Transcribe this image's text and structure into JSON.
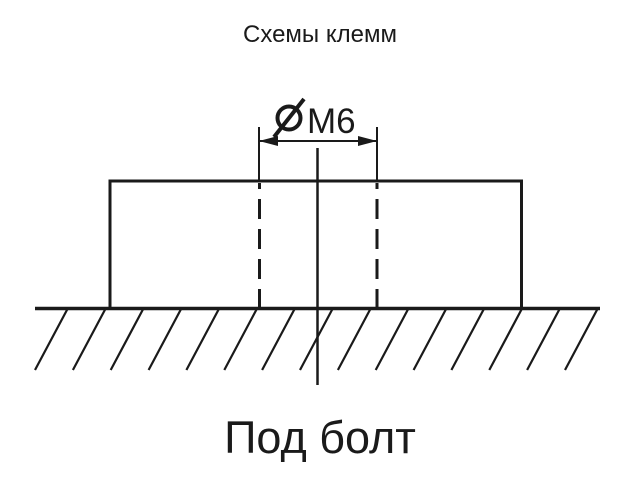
{
  "title": "Схемы клемм",
  "caption": "Под болт",
  "dimension": {
    "symbol": "⌀",
    "label": "M6",
    "full_text": "⌀M6"
  },
  "colors": {
    "line": "#1a1a1a",
    "background": "#ffffff"
  }
}
